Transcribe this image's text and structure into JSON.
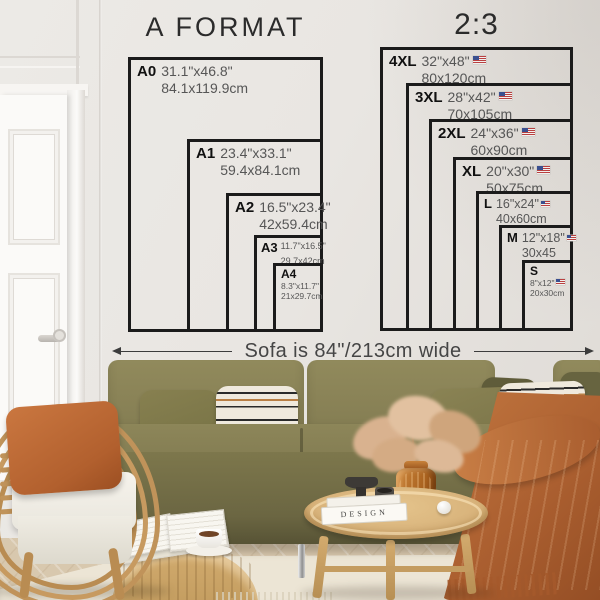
{
  "page": {
    "description": "Poster size guide wall chart above a sofa"
  },
  "charts": {
    "a_format": {
      "title": "A FORMAT",
      "sizes": [
        {
          "code": "A0",
          "inches": "31.1\"x46.8\"",
          "cm": "84.1x119.9cm"
        },
        {
          "code": "A1",
          "inches": "23.4\"x33.1\"",
          "cm": "59.4x84.1cm"
        },
        {
          "code": "A2",
          "inches": "16.5\"x23.4\"",
          "cm": "42x59.4cm"
        },
        {
          "code": "A3",
          "inches": "11.7\"x16.5\"",
          "cm": "29.7x42cm"
        },
        {
          "code": "A4",
          "inches": "8.3\"x11.7\"",
          "cm": "21x29.7cm"
        }
      ]
    },
    "ratio_2_3": {
      "title": "2:3",
      "sizes": [
        {
          "code": "4XL",
          "inches": "32\"x48\"",
          "cm": "80x120cm",
          "flag": "us"
        },
        {
          "code": "3XL",
          "inches": "28\"x42\"",
          "cm": "70x105cm",
          "flag": "us"
        },
        {
          "code": "2XL",
          "inches": "24\"x36\"",
          "cm": "60x90cm",
          "flag": "us"
        },
        {
          "code": "XL",
          "inches": "20\"x30\"",
          "cm": "50x75cm",
          "flag": "us"
        },
        {
          "code": "L",
          "inches": "16\"x24\"",
          "cm": "40x60cm",
          "flag": "us"
        },
        {
          "code": "M",
          "inches": "12\"x18\"",
          "cm": "30x45",
          "flag": "us"
        },
        {
          "code": "S",
          "inches": "8\"x12\"",
          "cm": "20x30cm",
          "flag": "us"
        }
      ]
    },
    "sofa_note": "Sofa is 84\"/213cm wide"
  },
  "decor": {
    "book_spine": "DESIGN"
  },
  "colors": {
    "diagram_line": "#1b1b1b",
    "label_gray": "#565656",
    "wall": "#e9e6e2",
    "sofa_olive": "#878053",
    "throw_rust": "#b2683a",
    "rattan": "#c0935a",
    "pouf_tan": "#c8a265",
    "table_wood": "#d9b47c",
    "rug_cream": "#ece5d5",
    "floor_dark_wood": "#7c4a2c",
    "flag_red": "#b94040",
    "flag_blue": "#3a4f8f"
  }
}
